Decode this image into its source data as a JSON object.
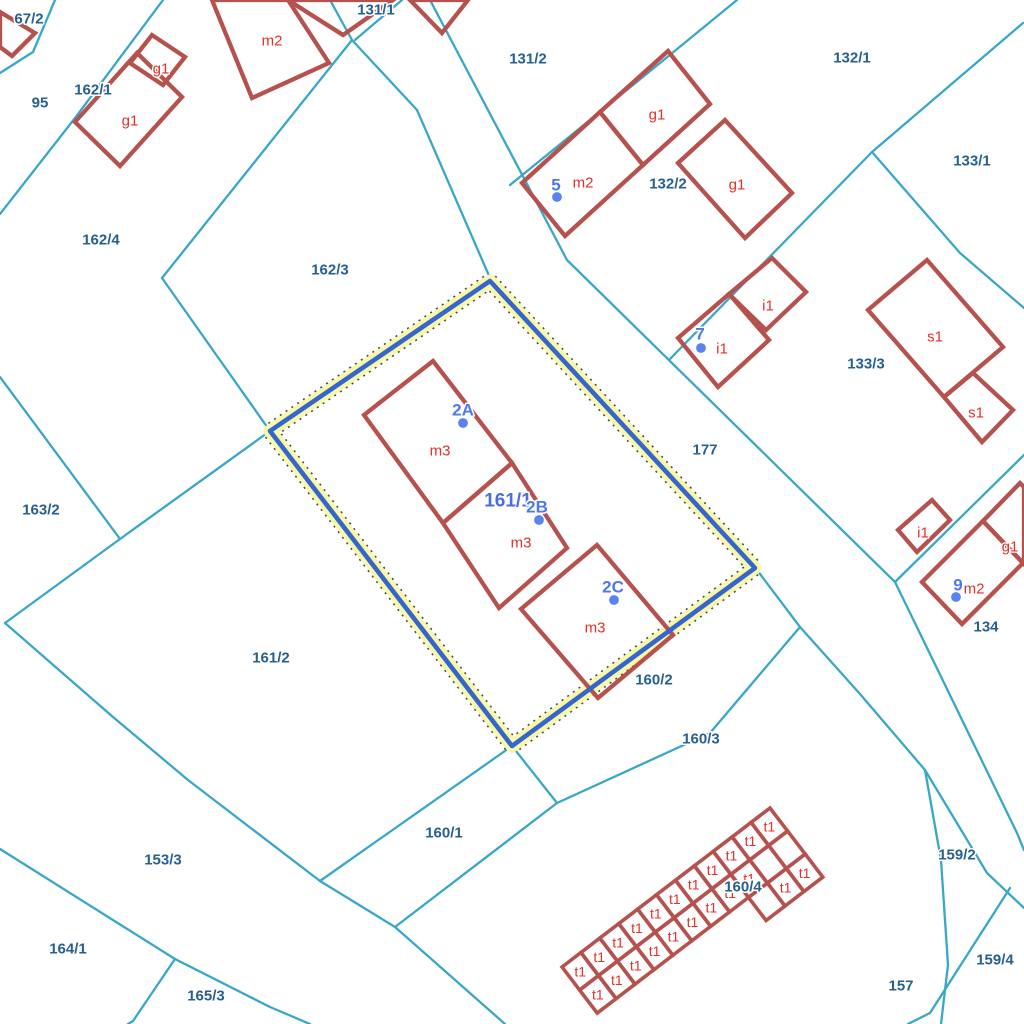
{
  "map": {
    "background": "#ffffff",
    "colors": {
      "parcel_line": "#38a7c8",
      "building": "#b5524e",
      "building_label": "#e2302a",
      "parcel_label": "#27608f",
      "address_label": "#4f79ea",
      "address_dot": "#5b83f0",
      "selected_label": "#4a6ede",
      "highlight_halo": "#f8f8a8",
      "highlight_dots": "#444444",
      "highlight_line": "#3566cf",
      "label_halo": "#ffffff"
    },
    "parcel_lines": [
      {
        "points": [
          [
            55,
            0
          ],
          [
            33,
            52
          ],
          [
            0,
            73
          ]
        ]
      },
      {
        "points": [
          [
            163,
            0
          ],
          [
            75,
            118
          ],
          [
            0,
            214
          ]
        ]
      },
      {
        "points": [
          [
            0,
            377
          ],
          [
            120,
            539
          ],
          [
            5,
            623
          ]
        ]
      },
      {
        "points": [
          [
            120,
            539
          ],
          [
            270,
            431
          ]
        ]
      },
      {
        "points": [
          [
            5,
            623
          ],
          [
            113,
            717
          ],
          [
            188,
            780
          ],
          [
            320,
            881
          ],
          [
            395,
            927
          ],
          [
            505,
            1024
          ]
        ]
      },
      {
        "points": [
          [
            320,
            881
          ],
          [
            512,
            746
          ]
        ]
      },
      {
        "points": [
          [
            512,
            746
          ],
          [
            557,
            803
          ]
        ]
      },
      {
        "points": [
          [
            800,
            627
          ],
          [
            710,
            733
          ],
          [
            557,
            803
          ],
          [
            395,
            927
          ]
        ]
      },
      {
        "points": [
          [
            330,
            0
          ],
          [
            352,
            40
          ],
          [
            417,
            110
          ],
          [
            490,
            278
          ],
          [
            757,
            570
          ],
          [
            800,
            627
          ],
          [
            860,
            694
          ],
          [
            925,
            770
          ],
          [
            987,
            873
          ],
          [
            1024,
            908
          ]
        ]
      },
      {
        "points": [
          [
            430,
            0
          ],
          [
            567,
            260
          ],
          [
            895,
            582
          ],
          [
            1017,
            833
          ],
          [
            1024,
            850
          ]
        ]
      },
      {
        "points": [
          [
            737,
            0
          ],
          [
            660,
            63
          ],
          [
            510,
            185
          ]
        ]
      },
      {
        "points": [
          [
            1023,
            23
          ],
          [
            872,
            152
          ],
          [
            669,
            360
          ]
        ]
      },
      {
        "points": [
          [
            872,
            152
          ],
          [
            960,
            253
          ],
          [
            1024,
            308
          ]
        ]
      },
      {
        "points": [
          [
            1024,
            455
          ],
          [
            895,
            582
          ]
        ]
      },
      {
        "points": [
          [
            925,
            770
          ],
          [
            941,
            860
          ],
          [
            948,
            965
          ],
          [
            941,
            1024
          ]
        ]
      },
      {
        "points": [
          [
            1010,
            888
          ],
          [
            930,
            1013
          ],
          [
            908,
            1024
          ]
        ]
      },
      {
        "points": [
          [
            0,
            849
          ],
          [
            175,
            959
          ],
          [
            270,
            1007
          ],
          [
            310,
            1024
          ]
        ]
      },
      {
        "points": [
          [
            175,
            959
          ],
          [
            133,
            1021
          ],
          [
            128,
            1024
          ]
        ]
      },
      {
        "points": [
          [
            352,
            40
          ],
          [
            162,
            278
          ]
        ]
      },
      {
        "points": [
          [
            162,
            278
          ],
          [
            270,
            431
          ]
        ]
      },
      {
        "points": [
          [
            355,
            40
          ],
          [
            402,
            0
          ]
        ]
      }
    ],
    "selected_parcel": {
      "label": "161/1",
      "label_x": 508,
      "label_y": 501,
      "outline": [
        [
          490,
          281
        ],
        [
          755,
          568
        ],
        [
          512,
          746
        ],
        [
          270,
          431
        ]
      ]
    },
    "buildings": [
      {
        "points": [
          [
            0,
            12
          ],
          [
            35,
            33
          ],
          [
            12,
            56
          ],
          [
            0,
            47
          ]
        ]
      },
      {
        "points": [
          [
            75,
            122
          ],
          [
            137,
            53
          ],
          [
            182,
            97
          ],
          [
            120,
            166
          ]
        ]
      },
      {
        "points": [
          [
            152,
            35
          ],
          [
            185,
            57
          ],
          [
            163,
            85
          ],
          [
            130,
            63
          ]
        ]
      },
      {
        "points": [
          [
            212,
            0
          ],
          [
            288,
            0
          ],
          [
            329,
            63
          ],
          [
            252,
            98
          ]
        ]
      },
      {
        "points": [
          [
            288,
            0
          ],
          [
            343,
            35
          ],
          [
            393,
            0
          ]
        ]
      },
      {
        "points": [
          [
            410,
            0
          ],
          [
            468,
            0
          ],
          [
            442,
            33
          ]
        ]
      },
      {
        "points": [
          [
            522,
            183
          ],
          [
            600,
            112
          ],
          [
            643,
            165
          ],
          [
            565,
            236
          ]
        ]
      },
      {
        "points": [
          [
            600,
            112
          ],
          [
            668,
            51
          ],
          [
            710,
            104
          ],
          [
            643,
            165
          ]
        ]
      },
      {
        "points": [
          [
            678,
            163
          ],
          [
            725,
            120
          ],
          [
            792,
            193
          ],
          [
            745,
            238
          ]
        ]
      },
      {
        "points": [
          [
            678,
            338
          ],
          [
            729,
            294
          ],
          [
            769,
            340
          ],
          [
            718,
            387
          ]
        ]
      },
      {
        "points": [
          [
            729,
            294
          ],
          [
            772,
            258
          ],
          [
            806,
            292
          ],
          [
            766,
            330
          ]
        ]
      },
      {
        "points": [
          [
            868,
            310
          ],
          [
            927,
            260
          ],
          [
            1003,
            347
          ],
          [
            944,
            397
          ]
        ]
      },
      {
        "points": [
          [
            944,
            397
          ],
          [
            973,
            373
          ],
          [
            1013,
            410
          ],
          [
            982,
            442
          ]
        ]
      },
      {
        "points": [
          [
            898,
            530
          ],
          [
            932,
            500
          ],
          [
            950,
            520
          ],
          [
            917,
            552
          ]
        ]
      },
      {
        "points": [
          [
            922,
            582
          ],
          [
            983,
            521
          ],
          [
            1023,
            563
          ],
          [
            962,
            624
          ]
        ]
      },
      {
        "points": [
          [
            983,
            521
          ],
          [
            1020,
            483
          ],
          [
            1024,
            487
          ],
          [
            1024,
            560
          ],
          [
            1023,
            563
          ]
        ]
      },
      {
        "points": [
          [
            433,
            361
          ],
          [
            512,
            463
          ],
          [
            443,
            523
          ],
          [
            364,
            415
          ]
        ]
      },
      {
        "points": [
          [
            512,
            463
          ],
          [
            567,
            548
          ],
          [
            499,
            608
          ],
          [
            443,
            523
          ]
        ]
      },
      {
        "points": [
          [
            597,
            545
          ],
          [
            673,
            635
          ],
          [
            598,
            698
          ],
          [
            521,
            609
          ]
        ]
      }
    ],
    "building_labels": [
      {
        "text": "m2",
        "x": 272,
        "y": 41
      },
      {
        "text": "g1",
        "x": 161,
        "y": 69
      },
      {
        "text": "g1",
        "x": 130,
        "y": 121
      },
      {
        "text": "m2",
        "x": 583,
        "y": 183
      },
      {
        "text": "g1",
        "x": 657,
        "y": 115
      },
      {
        "text": "g1",
        "x": 737,
        "y": 185
      },
      {
        "text": "i1",
        "x": 768,
        "y": 306
      },
      {
        "text": "i1",
        "x": 722,
        "y": 349
      },
      {
        "text": "s1",
        "x": 935,
        "y": 337
      },
      {
        "text": "s1",
        "x": 976,
        "y": 413
      },
      {
        "text": "i1",
        "x": 923,
        "y": 533
      },
      {
        "text": "g1",
        "x": 1010,
        "y": 547
      },
      {
        "text": "m2",
        "x": 974,
        "y": 589
      },
      {
        "text": "m3",
        "x": 440,
        "y": 451
      },
      {
        "text": "m3",
        "x": 521,
        "y": 543
      },
      {
        "text": "m3",
        "x": 595,
        "y": 628
      }
    ],
    "parcel_labels": [
      {
        "text": "67/2",
        "x": 29,
        "y": 19
      },
      {
        "text": "95",
        "x": 40,
        "y": 103
      },
      {
        "text": "162/1",
        "x": 93,
        "y": 90
      },
      {
        "text": "162/4",
        "x": 101,
        "y": 240
      },
      {
        "text": "162/3",
        "x": 330,
        "y": 270
      },
      {
        "text": "131/1",
        "x": 376,
        "y": 10
      },
      {
        "text": "131/2",
        "x": 528,
        "y": 59
      },
      {
        "text": "132/1",
        "x": 852,
        "y": 58
      },
      {
        "text": "132/2",
        "x": 668,
        "y": 184
      },
      {
        "text": "133/1",
        "x": 972,
        "y": 161
      },
      {
        "text": "133/3",
        "x": 866,
        "y": 364
      },
      {
        "text": "177",
        "x": 705,
        "y": 450
      },
      {
        "text": "163/2",
        "x": 41,
        "y": 510
      },
      {
        "text": "161/2",
        "x": 271,
        "y": 658
      },
      {
        "text": "134",
        "x": 986,
        "y": 627
      },
      {
        "text": "160/2",
        "x": 654,
        "y": 680
      },
      {
        "text": "160/3",
        "x": 701,
        "y": 739
      },
      {
        "text": "160/1",
        "x": 444,
        "y": 833
      },
      {
        "text": "160/4",
        "x": 743,
        "y": 887
      },
      {
        "text": "153/3",
        "x": 163,
        "y": 860
      },
      {
        "text": "164/1",
        "x": 68,
        "y": 949
      },
      {
        "text": "165/3",
        "x": 206,
        "y": 996
      },
      {
        "text": "157",
        "x": 901,
        "y": 986
      },
      {
        "text": "159/2",
        "x": 957,
        "y": 855
      },
      {
        "text": "159/4",
        "x": 995,
        "y": 960
      }
    ],
    "address_points": [
      {
        "label": "5",
        "x": 556,
        "y": 185,
        "dot_x": 557,
        "dot_y": 197
      },
      {
        "label": "7",
        "x": 700,
        "y": 334,
        "dot_x": 701,
        "dot_y": 348
      },
      {
        "label": "9",
        "x": 958,
        "y": 585,
        "dot_x": 956,
        "dot_y": 597
      },
      {
        "label": "2A",
        "x": 463,
        "y": 410,
        "dot_x": 463,
        "dot_y": 423
      },
      {
        "label": "2B",
        "x": 537,
        "y": 507,
        "dot_x": 539,
        "dot_y": 520
      },
      {
        "label": "2C",
        "x": 613,
        "y": 587,
        "dot_x": 614,
        "dot_y": 600
      }
    ],
    "garages": {
      "origin_x": 562,
      "origin_y": 967,
      "angle_deg": -37.4,
      "cell_w": 23.8,
      "cell_h": 29,
      "cols": 11,
      "rows": 2,
      "extra_row_cols": [
        8,
        9,
        10
      ],
      "cell_label": "t1",
      "no_label_cells": [
        [
          1,
          9
        ],
        [
          1,
          10
        ],
        [
          2,
          8
        ]
      ]
    }
  }
}
